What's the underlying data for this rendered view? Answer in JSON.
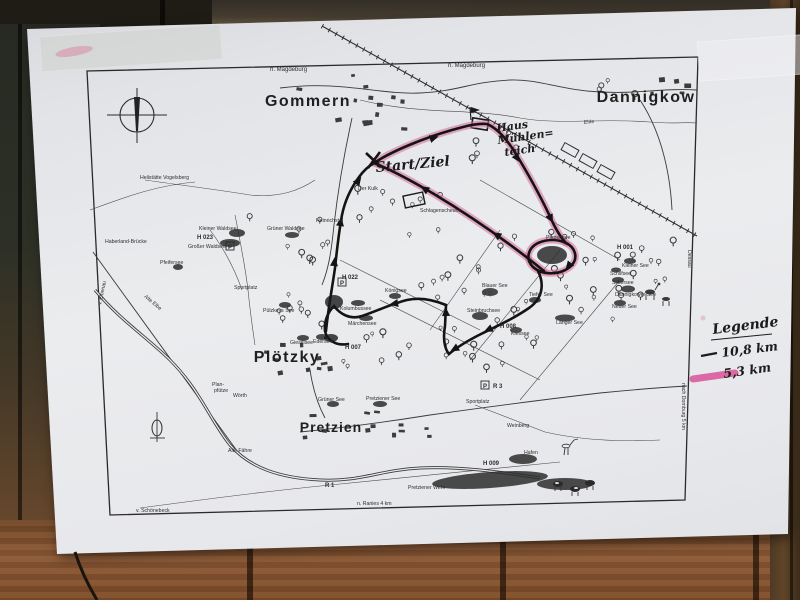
{
  "towns": {
    "gommern": "Gommern",
    "dannigkow": "Dannigkow",
    "ploetzky": "Plötzky",
    "pretzien": "Pretzien"
  },
  "directions": {
    "magdeburg_nw": "n. Magdeburg",
    "magdeburg_ne": "n. Magdeburg",
    "schoenebeck": "v. Schönebeck",
    "ranies": "n. Ranies 4 km",
    "elbenau": "v. Elbenau",
    "dessau": "Dessau",
    "dornburg": "nach Dornburg 5 km"
  },
  "lakes": {
    "kleiner_waldsee": "Kleiner Waldsee",
    "grosser_waldsee": "Großer Waldsee",
    "gruener_waldsee": "Grüner Waldsee",
    "pfeifersee": "Pfeifersee",
    "puelzkeys_see": "Pülzkeys See",
    "kolumbussee": "Kolumbussee",
    "maerchensee": "Märchensee",
    "koenigsee": "Königsee",
    "gieselsee": "Gieselsee",
    "edersee": "Edersee",
    "plattensee": "Plattensee",
    "kleiner_see": "Kleiner See",
    "schilfsee": "Schilfsee",
    "silbersee": "Silbersee",
    "dannigkower_see": "Dannigkower See",
    "neuer_see": "Neuer See",
    "langer_see": "Langer See",
    "blauer_see": "Blauer See",
    "steinbruchsee": "Steinbruchsee",
    "kiessee": "Kiessee",
    "tiefer_see": "Tiefer See",
    "gruener_see": "Grüner See",
    "pretziener_see": "Pretziener See"
  },
  "waterways": {
    "alte_elbe": "Alte Elbe",
    "ehle": "Ehle",
    "pretziener_wehr": "Pretziener Wehr"
  },
  "pois": {
    "h023": "H 023",
    "h022": "H 022",
    "h007": "H 007",
    "h001": "H 001",
    "h008": "H 008",
    "h009": "H 009",
    "sportplatz_w": "Sportplatz",
    "sportplatz_pretzien": "Sportplatz",
    "der_kulk": "Der Kulk",
    "heinrichstal": "Heinrichstal",
    "schlagenscheune": "Schlagenscheune",
    "heilstaette": "Heilstätte Vogelsberg",
    "haberland_bruecke": "Haberland-Brücke",
    "planpfuetze_1": "Plan-",
    "planpfuetze_2": "pfütze",
    "woerth": "Wörth",
    "alte_faehre": "Alte Fähre",
    "weinberg": "Weinberg",
    "hafen": "Hafen",
    "r1": "R 1",
    "r3": "R 3",
    "parking": "P"
  },
  "handwriting": {
    "start_ziel": "Start/Ziel",
    "haus_line1": "Haus",
    "haus_line2": "Mühlen=",
    "haus_line3": "teich"
  },
  "legend": {
    "title": "Legende",
    "items": [
      {
        "label": "10,8 km",
        "color": "#1c1c1c"
      },
      {
        "label": "5,3 km",
        "color": "#d84a94"
      }
    ]
  }
}
